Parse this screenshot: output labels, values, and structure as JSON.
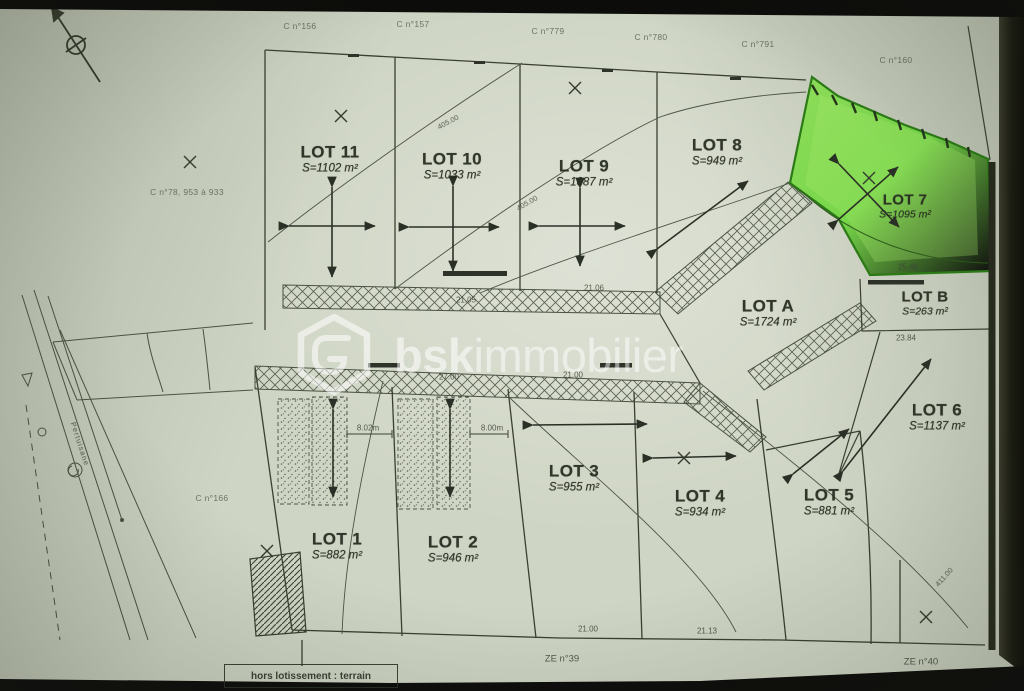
{
  "watermark": {
    "brand_bold": "bsk",
    "brand_light": "immobilier"
  },
  "lots": {
    "lot1": {
      "name": "LOT 1",
      "area": "S=882 m²"
    },
    "lot2": {
      "name": "LOT 2",
      "area": "S=946 m²"
    },
    "lot3": {
      "name": "LOT 3",
      "area": "S=955 m²"
    },
    "lot4": {
      "name": "LOT 4",
      "area": "S=934 m²"
    },
    "lot5": {
      "name": "LOT 5",
      "area": "S=881 m²"
    },
    "lot6": {
      "name": "LOT 6",
      "area": "S=1137 m²"
    },
    "lot7": {
      "name": "LOT 7",
      "area": "S=1095 m²",
      "highlight_color": "#6fd63f"
    },
    "lot8": {
      "name": "LOT 8",
      "area": "S=949 m²"
    },
    "lot9": {
      "name": "LOT 9",
      "area": "S=1087 m²"
    },
    "lot10": {
      "name": "LOT 10",
      "area": "S=1033 m²"
    },
    "lot11": {
      "name": "LOT 11",
      "area": "S=1102 m²"
    },
    "lotA": {
      "name": "LOT A",
      "area": "S=1724 m²"
    },
    "lotB": {
      "name": "LOT B",
      "area": "S=263 m²"
    }
  },
  "parcels": {
    "p156": "C n°156",
    "p157": "C n°157",
    "p779": "C n°779",
    "p780": "C n°780",
    "p791": "C n°791",
    "p160": "C n°160",
    "p78": "C n°78, 953 à 933",
    "p166": "C n°166"
  },
  "zones": {
    "ze39": "ZE n°39",
    "ze40": "ZE n°40"
  },
  "note": {
    "hors_lotissement": "hors lotissement : terrain"
  },
  "road": {
    "name": "Pertuisane"
  },
  "dims": {
    "d8_02": "8.02m",
    "d8_00": "8.00m",
    "d21_00a": "21.00",
    "d21_13": "21.13",
    "d23_84": "23.84",
    "d25_48": "25.48",
    "d27_00": "27.00",
    "d21_00b": "21.00",
    "d21_05": "21.05",
    "d21_06": "21.06"
  },
  "contours": {
    "c405a": "405.00",
    "c405b": "405.00",
    "c411": "411.00"
  }
}
